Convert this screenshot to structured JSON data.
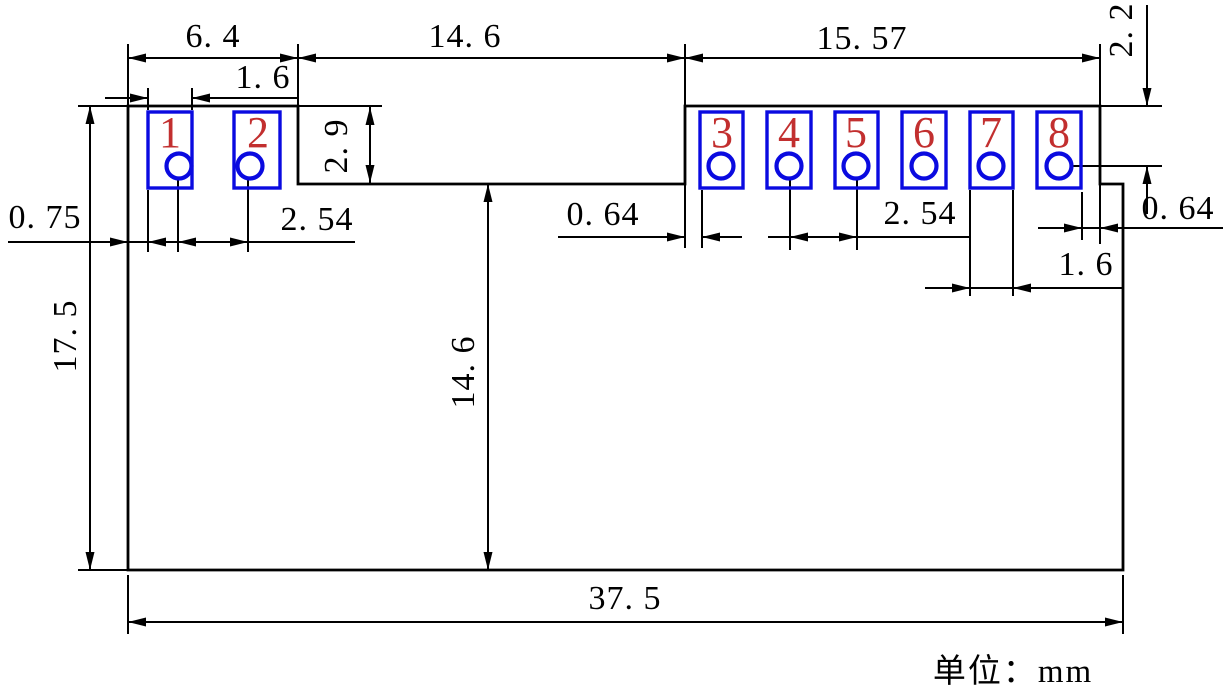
{
  "drawing": {
    "type": "mechanical-dimension-drawing",
    "units_label": "单位：mm",
    "pads": [
      {
        "number": "1"
      },
      {
        "number": "2"
      },
      {
        "number": "3"
      },
      {
        "number": "4"
      },
      {
        "number": "5"
      },
      {
        "number": "6"
      },
      {
        "number": "7"
      },
      {
        "number": "8"
      }
    ],
    "dimensions": {
      "section_left_width": "6. 4",
      "pad1_width": "1. 6",
      "notch_width": "14. 6",
      "section_right_width": "15. 57",
      "pad_center_from_top_edge": "2. 2",
      "pad_strip_height": "2. 9",
      "left_edge_to_pad1": "0. 75",
      "pitch_left": "2. 54",
      "edge_to_pad3": "0. 64",
      "pitch_right": "2. 54",
      "pad7_width": "1. 6",
      "pad8_to_edge": "0. 64",
      "body_height": "17. 5",
      "notch_depth": "14. 6",
      "body_width": "37. 5"
    },
    "colors": {
      "line": "#000000",
      "pad_outline": "#0a0ae0",
      "pad_number": "#c22f2f",
      "background": "#ffffff"
    }
  }
}
